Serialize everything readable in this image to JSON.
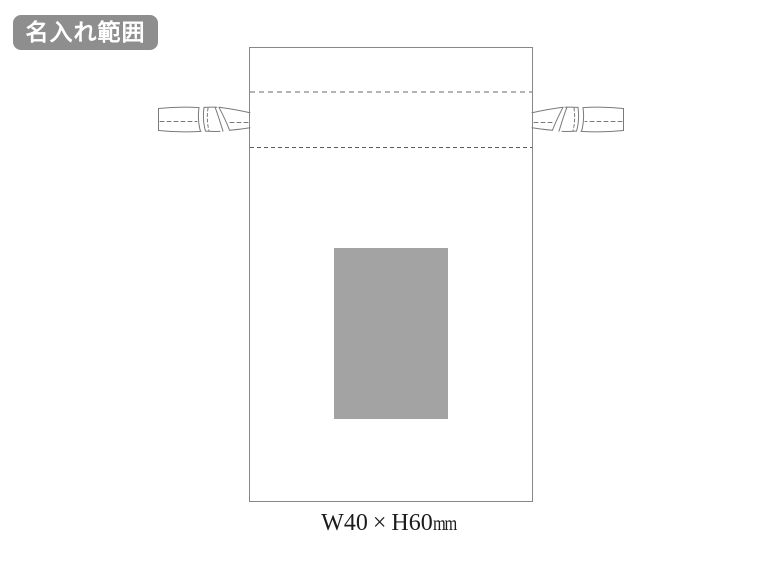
{
  "badge": {
    "label": "名入れ範囲",
    "bg_color": "#8e8e8e",
    "text_color": "#ffffff"
  },
  "pouch_diagram": {
    "outline_color": "#878787",
    "channel_top_dash_color": "#b4b4b4",
    "channel_bottom_dash_color": "#5c5c5c",
    "tie_outline_color": "#7a7a7a",
    "print_area_fill": "#a3a3a3"
  },
  "dimension_label": {
    "main": "W40 × H60",
    "unit": "mm"
  }
}
